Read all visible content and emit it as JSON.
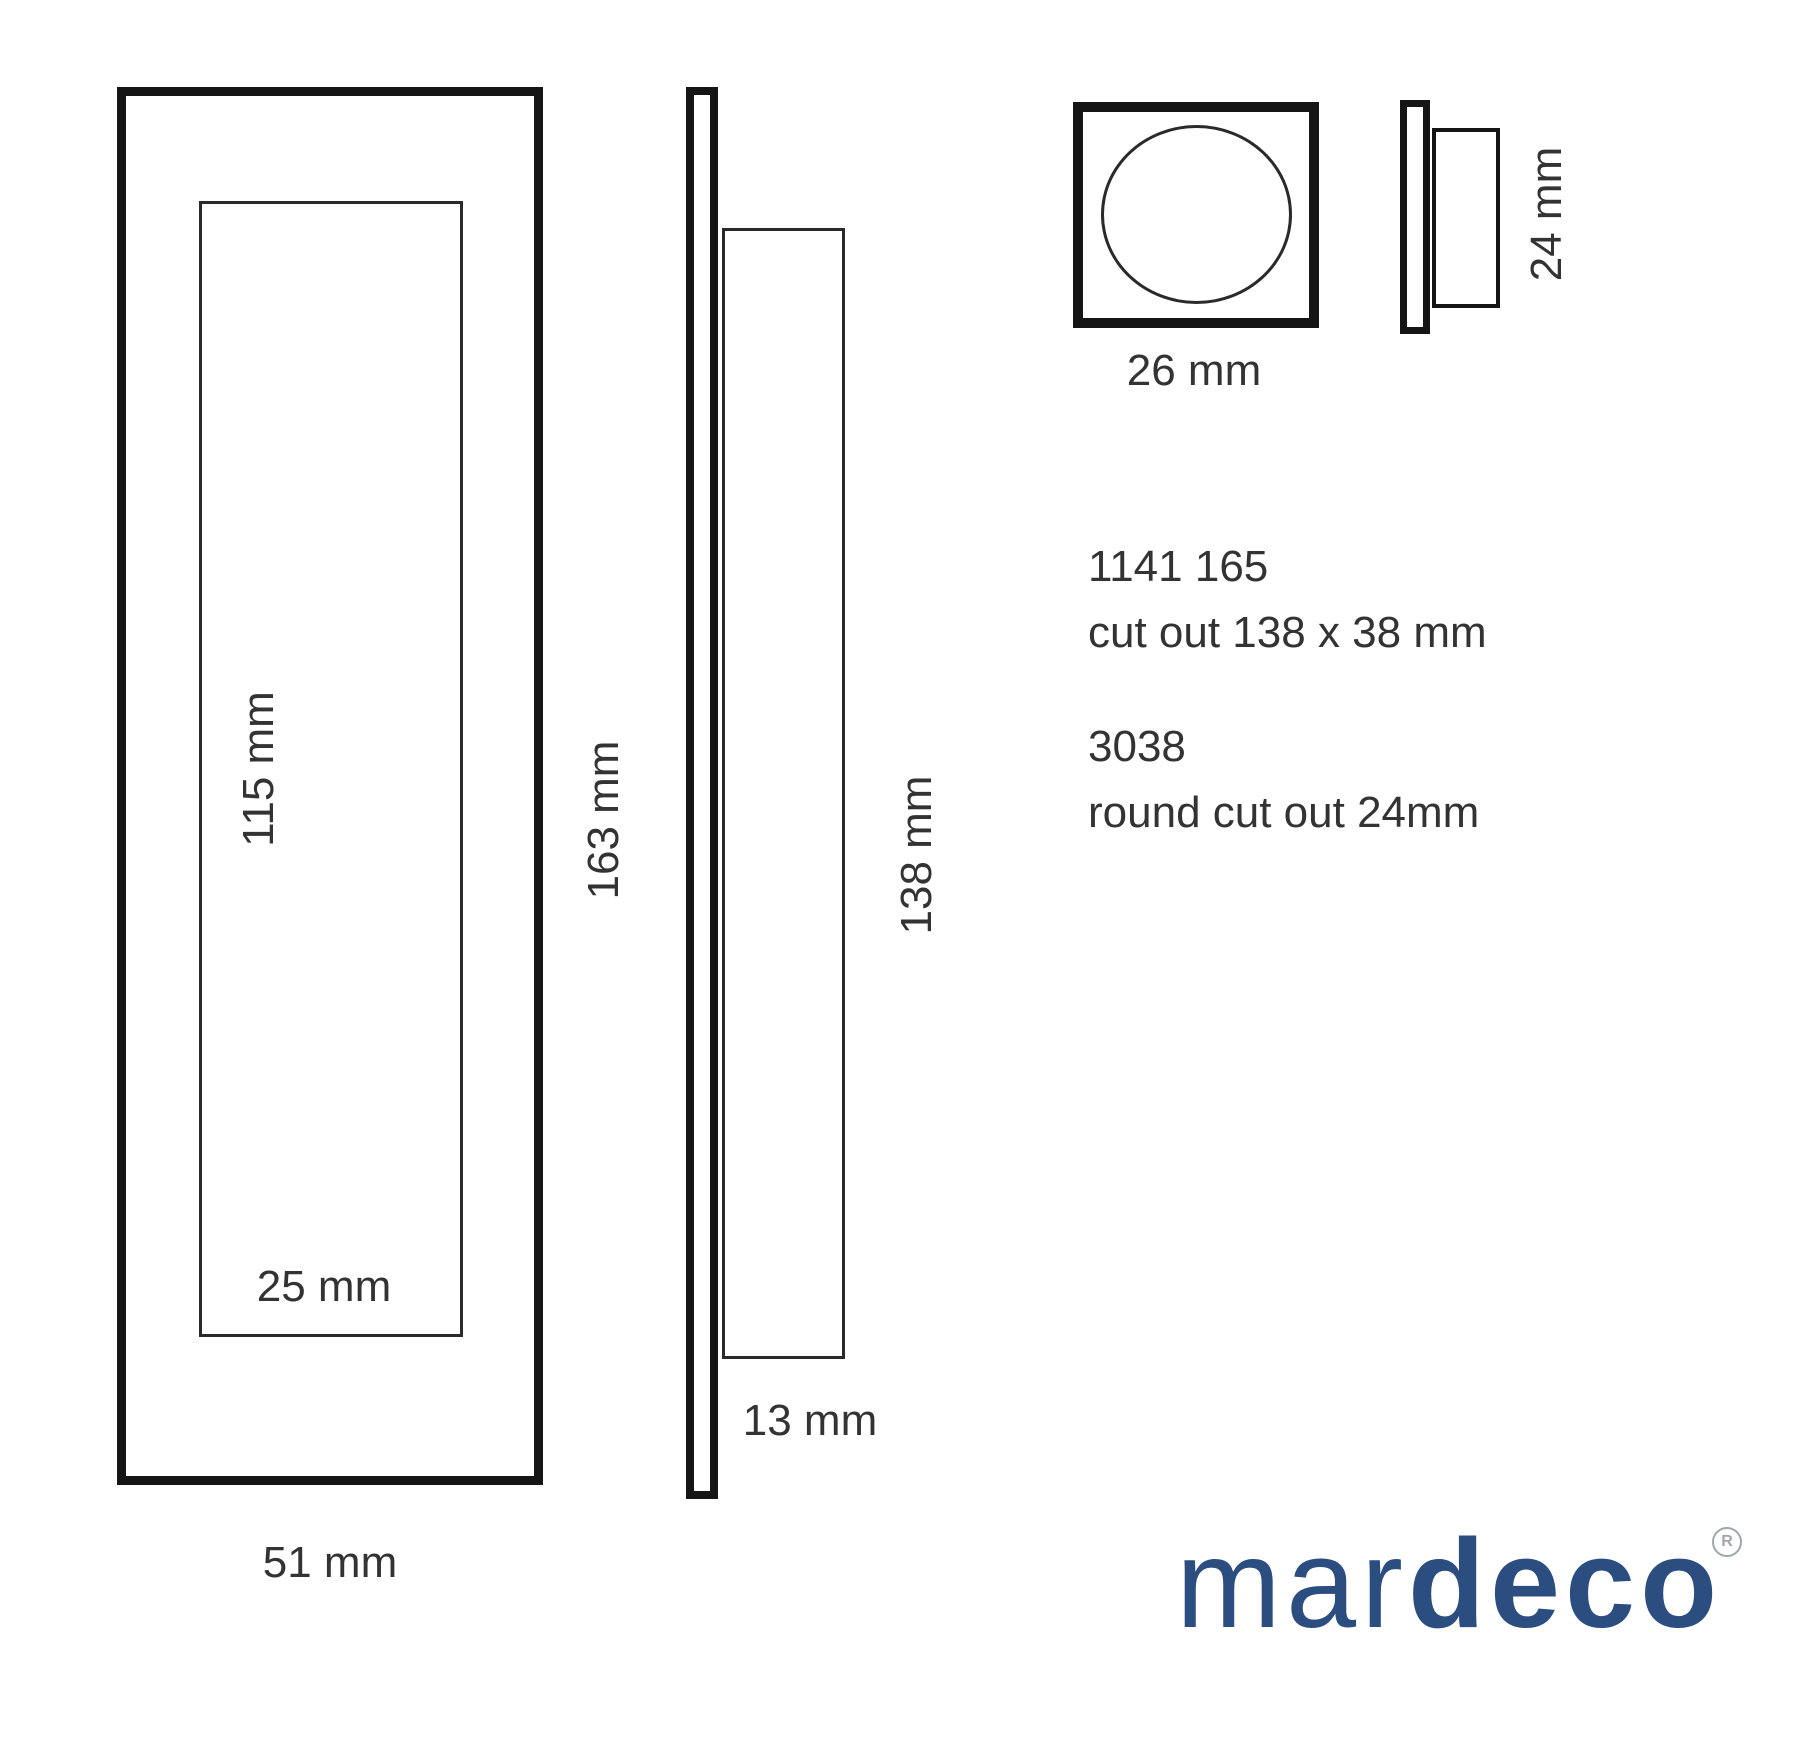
{
  "title": "mardeco flush pull technical drawing",
  "front_view": {
    "recess_height_label": "115 mm",
    "recess_width_label": "25 mm",
    "overall_width_label": "51 mm"
  },
  "side_view": {
    "overall_height_label": "163 mm",
    "recess_height_label": "138 mm",
    "depth_label": "13 mm"
  },
  "round_pull_view": {
    "face_width_label": "26 mm",
    "depth_label": "24 mm"
  },
  "products": [
    {
      "code": "1141 165",
      "cutout": "cut out 138 x 38 mm"
    },
    {
      "code": "3038",
      "cutout": "round cut out 24mm"
    }
  ],
  "logo": {
    "prefix": "mar",
    "suffix": "deco",
    "registered_mark": "R"
  },
  "colors": {
    "line_black": "#151515",
    "thin_line": "#2a2a2a",
    "dimension_text": "#333333",
    "brand_blue": "#2b4d7f",
    "registered_gray": "#9fa6ae",
    "background": "#ffffff"
  }
}
